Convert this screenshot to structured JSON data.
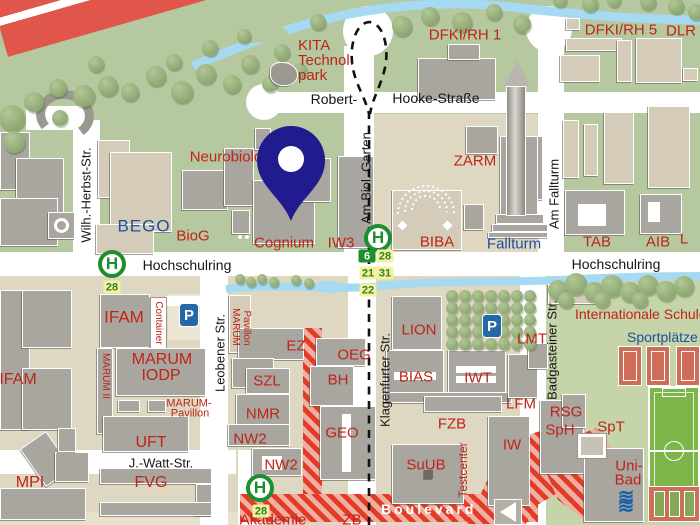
{
  "map_type": "campus-street-map",
  "colors": {
    "red": "#bf2418",
    "blue": "#1d4f9b",
    "black": "#161616",
    "road": "#ffffff",
    "river": "#a5daf2",
    "park_green": "#b6c8a0",
    "east_green": "#c6d4aa",
    "campus_beige": "#ded7c1",
    "building_gray": "#a9a6a0",
    "building_beige": "#d4ccb8",
    "bus_green": "#1e8f2f",
    "badge_yellow": "#f3f0a0",
    "badge_text": "#2f8422",
    "hatch_red": "#e23c28",
    "hatch_pink": "#efb0a2",
    "autobahn_red": "#e0564a",
    "parking_blue": "#2468a8",
    "pitch_green": "#7db54a",
    "court_red": "#cf6e58",
    "wave_blue": "#1b62aa",
    "pin_navy": "#221b8f"
  },
  "glyphs": {
    "bus_stop": "H",
    "parking": "P"
  },
  "labels": [
    {
      "id": "kita-1",
      "t": "KITA",
      "c": "red",
      "x": 298,
      "y": 38,
      "a": "l",
      "s": 15
    },
    {
      "id": "kita-2",
      "t": "Technol.",
      "c": "red",
      "x": 298,
      "y": 53,
      "a": "l",
      "s": 15
    },
    {
      "id": "kita-3",
      "t": "park",
      "c": "red",
      "x": 298,
      "y": 68,
      "a": "l",
      "s": 15
    },
    {
      "id": "dfki-rh-1",
      "t": "DFKI/RH 1",
      "c": "red",
      "x": 465,
      "y": 35,
      "s": 15
    },
    {
      "id": "dfki-rh-5",
      "t": "DFKI/RH 5",
      "c": "red",
      "x": 621,
      "y": 30,
      "s": 15
    },
    {
      "id": "dlr",
      "t": "DLR",
      "c": "red",
      "x": 681,
      "y": 31,
      "s": 15
    },
    {
      "id": "neurobiologie",
      "t": "Neurobiologie",
      "c": "red",
      "x": 236,
      "y": 157,
      "s": 15
    },
    {
      "id": "bego",
      "t": "BEGO",
      "c": "blue",
      "x": 144,
      "y": 226,
      "s": 17,
      "ls": 1
    },
    {
      "id": "biog",
      "t": "BioG",
      "c": "red",
      "x": 193,
      "y": 236,
      "s": 15
    },
    {
      "id": "cognium",
      "t": "Cognium",
      "c": "red",
      "x": 284,
      "y": 243,
      "s": 15
    },
    {
      "id": "iw3",
      "t": "IW3",
      "c": "red",
      "x": 341,
      "y": 243,
      "s": 15
    },
    {
      "id": "zarm",
      "t": "ZARM",
      "c": "red",
      "x": 475,
      "y": 161,
      "s": 15
    },
    {
      "id": "fallturm",
      "t": "Fallturm",
      "c": "blue",
      "x": 514,
      "y": 244,
      "s": 15
    },
    {
      "id": "biba",
      "t": "BIBA",
      "c": "red",
      "x": 437,
      "y": 242,
      "s": 15
    },
    {
      "id": "tab",
      "t": "TAB",
      "c": "red",
      "x": 597,
      "y": 242,
      "s": 15
    },
    {
      "id": "aib",
      "t": "AIB",
      "c": "red",
      "x": 658,
      "y": 242,
      "s": 15
    },
    {
      "id": "l-cut",
      "t": "L",
      "c": "red",
      "x": 684,
      "y": 239,
      "s": 15
    },
    {
      "id": "robert",
      "t": "Robert-",
      "c": "black",
      "x": 334,
      "y": 99,
      "s": 14
    },
    {
      "id": "hooke",
      "t": "Hooke-Straße",
      "c": "black",
      "x": 436,
      "y": 98,
      "s": 14
    },
    {
      "id": "hochschulring-west",
      "t": "Hochschulring",
      "c": "black",
      "x": 187,
      "y": 265,
      "s": 14
    },
    {
      "id": "hochschulring-ost",
      "t": "Hochschulring",
      "c": "black",
      "x": 616,
      "y": 264,
      "s": 14
    },
    {
      "id": "wilh-herbst-str",
      "t": "Wilh.-Herbst-Str.",
      "c": "black",
      "x": 86,
      "y": 195,
      "r": -90,
      "s": 13
    },
    {
      "id": "am-biol-garten",
      "t": "Am Biol. Garten",
      "c": "black",
      "x": 366,
      "y": 178,
      "r": -90,
      "s": 13
    },
    {
      "id": "am-fallturm",
      "t": "Am Fallturm",
      "c": "black",
      "x": 554,
      "y": 194,
      "r": -90,
      "s": 13
    },
    {
      "id": "leobener-str",
      "t": "Leobener Str.",
      "c": "black",
      "x": 220,
      "y": 353,
      "r": -90,
      "s": 13
    },
    {
      "id": "klagenfurter-str",
      "t": "Klagenfurter Str.",
      "c": "black",
      "x": 385,
      "y": 380,
      "r": -90,
      "s": 13
    },
    {
      "id": "badgasteiner-str",
      "t": "Badgasteiner Str.",
      "c": "black",
      "x": 552,
      "y": 350,
      "r": -90,
      "s": 13
    },
    {
      "id": "j-watt-str",
      "t": "J.-Watt-Str.",
      "c": "black",
      "x": 161,
      "y": 463,
      "s": 13
    },
    {
      "id": "ifam-west",
      "t": "IFAM",
      "c": "red",
      "x": 18,
      "y": 380,
      "s": 16
    },
    {
      "id": "ifam",
      "t": "IFAM",
      "c": "red",
      "x": 124,
      "y": 317,
      "s": 17
    },
    {
      "id": "container",
      "t": "Container",
      "c": "red",
      "x": 158,
      "y": 323,
      "r": 90,
      "s": 10
    },
    {
      "id": "marum-ii",
      "t": "MARUM II",
      "c": "red",
      "x": 105,
      "y": 376,
      "r": 90,
      "s": 10
    },
    {
      "id": "marum",
      "t": "MARUM",
      "c": "red",
      "x": 162,
      "y": 360,
      "s": 16
    },
    {
      "id": "iodp",
      "t": "IODP",
      "c": "red",
      "x": 161,
      "y": 376,
      "s": 16
    },
    {
      "id": "marum-pavillon-1",
      "t": "MARUM-",
      "c": "red",
      "x": 189,
      "y": 404,
      "s": 11
    },
    {
      "id": "marum-pavillon-2",
      "t": "Pavillon",
      "c": "red",
      "x": 190,
      "y": 414,
      "s": 11
    },
    {
      "id": "marum-v",
      "t": "MARUM",
      "c": "red",
      "x": 235,
      "y": 327,
      "r": 90,
      "s": 10
    },
    {
      "id": "pavillon-v",
      "t": "Pavillon",
      "c": "red",
      "x": 246,
      "y": 328,
      "r": 90,
      "s": 10
    },
    {
      "id": "uft",
      "t": "UFT",
      "c": "red",
      "x": 151,
      "y": 443,
      "s": 16
    },
    {
      "id": "mpi",
      "t": "MPI",
      "c": "red",
      "x": 30,
      "y": 483,
      "s": 16
    },
    {
      "id": "fvg",
      "t": "FVG",
      "c": "red",
      "x": 151,
      "y": 483,
      "s": 16
    },
    {
      "id": "ez",
      "t": "EZ",
      "c": "red",
      "x": 296,
      "y": 346,
      "s": 15
    },
    {
      "id": "oeg",
      "t": "OEG",
      "c": "red",
      "x": 354,
      "y": 355,
      "s": 15
    },
    {
      "id": "bh",
      "t": "BH",
      "c": "red",
      "x": 338,
      "y": 380,
      "s": 15
    },
    {
      "id": "szl",
      "t": "SZL",
      "c": "red",
      "x": 267,
      "y": 381,
      "s": 15
    },
    {
      "id": "nmr",
      "t": "NMR",
      "c": "red",
      "x": 263,
      "y": 414,
      "s": 15
    },
    {
      "id": "nw2-a",
      "t": "NW2",
      "c": "red",
      "x": 250,
      "y": 439,
      "s": 15
    },
    {
      "id": "nw2-b",
      "t": "NW2",
      "c": "red",
      "x": 281,
      "y": 465,
      "s": 15
    },
    {
      "id": "geo",
      "t": "GEO",
      "c": "red",
      "x": 342,
      "y": 433,
      "s": 15
    },
    {
      "id": "suub",
      "t": "SuUB",
      "c": "red",
      "x": 426,
      "y": 465,
      "s": 15
    },
    {
      "id": "lion",
      "t": "LION",
      "c": "red",
      "x": 419,
      "y": 330,
      "s": 15
    },
    {
      "id": "bias",
      "t": "BIAS",
      "c": "red",
      "x": 416,
      "y": 377,
      "s": 15
    },
    {
      "id": "iwt",
      "t": "IWT",
      "c": "red",
      "x": 478,
      "y": 378,
      "s": 15
    },
    {
      "id": "lfm",
      "t": "LFM",
      "c": "red",
      "x": 521,
      "y": 404,
      "s": 15
    },
    {
      "id": "lmt",
      "t": "LMT",
      "c": "red",
      "x": 532,
      "y": 339,
      "s": 15
    },
    {
      "id": "fzb",
      "t": "FZB",
      "c": "red",
      "x": 452,
      "y": 424,
      "s": 15
    },
    {
      "id": "testcenter",
      "t": "Testcenter",
      "c": "red",
      "x": 463,
      "y": 470,
      "r": -90,
      "s": 12
    },
    {
      "id": "iw",
      "t": "IW",
      "c": "red",
      "x": 512,
      "y": 445,
      "s": 15
    },
    {
      "id": "rsg",
      "t": "RSG",
      "c": "red",
      "x": 566,
      "y": 412,
      "s": 15
    },
    {
      "id": "sph",
      "t": "SpH",
      "c": "red",
      "x": 560,
      "y": 430,
      "s": 15
    },
    {
      "id": "spt",
      "t": "SpT",
      "c": "red",
      "x": 611,
      "y": 427,
      "s": 15
    },
    {
      "id": "uni-bad-1",
      "t": "Uni-",
      "c": "red",
      "x": 629,
      "y": 466,
      "s": 15
    },
    {
      "id": "uni-bad-2",
      "t": "Bad",
      "c": "red",
      "x": 628,
      "y": 480,
      "s": 15
    },
    {
      "id": "internationale-schule",
      "t": "Internationale Schule",
      "c": "red",
      "x": 575,
      "y": 307,
      "a": "l",
      "s": 14
    },
    {
      "id": "sportplaetze",
      "t": "Sportplätze",
      "c": "blue",
      "x": 627,
      "y": 330,
      "a": "l",
      "s": 14
    },
    {
      "id": "akademie",
      "t": "Akademie",
      "c": "red",
      "x": 273,
      "y": 520,
      "s": 15
    },
    {
      "id": "zb",
      "t": "ZB",
      "c": "red",
      "x": 352,
      "y": 520,
      "s": 15
    },
    {
      "id": "boulevard",
      "t": "Boulevard",
      "c": "white",
      "x": 381,
      "y": 502,
      "a": "l",
      "s": 14,
      "b": 1,
      "ls": 3
    },
    {
      "id": "unibad-waves-1",
      "t": "≋",
      "c": "wave",
      "x": 627,
      "y": 497,
      "s": 20
    },
    {
      "id": "unibad-waves-2",
      "t": "≋",
      "c": "wave",
      "x": 627,
      "y": 507,
      "s": 20
    }
  ],
  "bus_stops": [
    {
      "id": "hochschulring-west",
      "x": 112,
      "y": 264,
      "routes": [
        {
          "n": "28",
          "x": 112,
          "y": 287,
          "style": "yellow"
        }
      ]
    },
    {
      "id": "am-biol-garten",
      "x": 378,
      "y": 238,
      "routes": [
        {
          "n": "6",
          "x": 367,
          "y": 256,
          "style": "green"
        },
        {
          "n": "28",
          "x": 385,
          "y": 256,
          "style": "yellow"
        },
        {
          "n": "21",
          "x": 368,
          "y": 273,
          "style": "yellow"
        },
        {
          "n": "31",
          "x": 385,
          "y": 273,
          "style": "yellow"
        },
        {
          "n": "22",
          "x": 368,
          "y": 290,
          "style": "yellow"
        }
      ]
    },
    {
      "id": "j-watt-str",
      "x": 260,
      "y": 488,
      "routes": [
        {
          "n": "28",
          "x": 261,
          "y": 511,
          "style": "yellow"
        }
      ]
    }
  ],
  "parking_lots": [
    {
      "id": "parking-ifam",
      "x": 189,
      "y": 315
    },
    {
      "id": "parking-lmt",
      "x": 492,
      "y": 326
    }
  ],
  "marker": {
    "x": 291,
    "y": 221
  }
}
